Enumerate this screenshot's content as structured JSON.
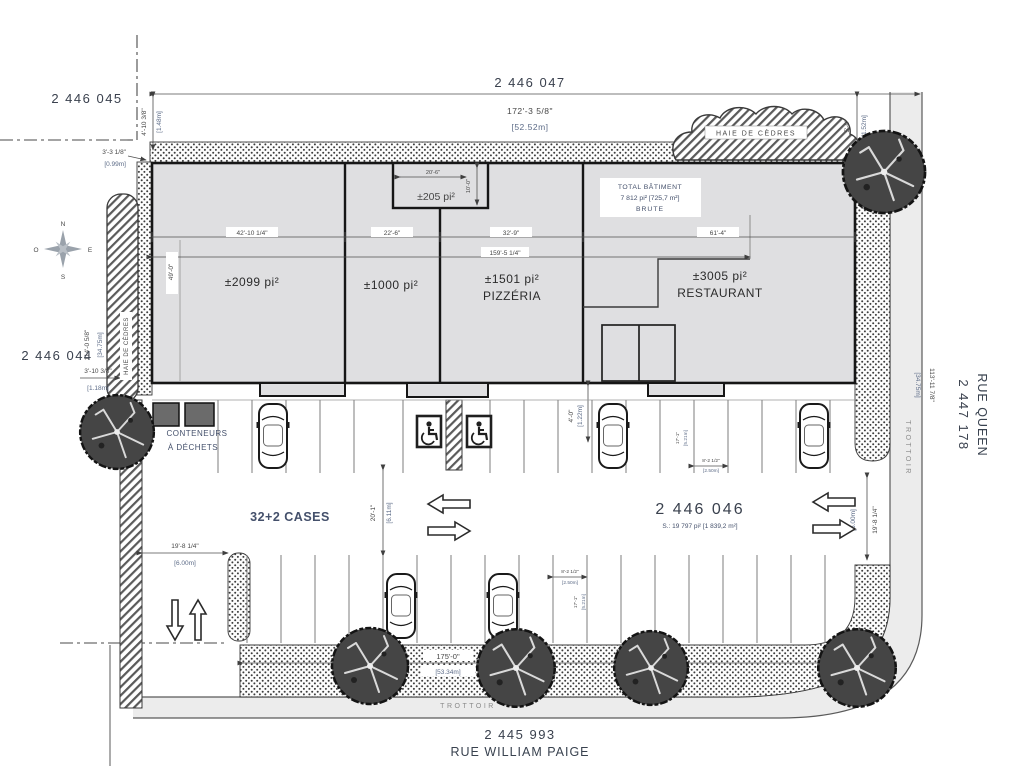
{
  "lots": {
    "l2446045": "2 446 045",
    "l2446047": "2 446 047",
    "l2446044": "2 446 044",
    "l2446046": "2 446 046",
    "l2446046_area": "S.: 19 797 pi² [1 839,2 m²]",
    "l2447178": "2 447 178",
    "l2445993": "2 445 993"
  },
  "streets": {
    "rue_queen": "RUE QUEEN",
    "rue_william_paige": "RUE WILLIAM PAIGE",
    "trottoir_right": "TROTTOIR",
    "trottoir_bottom": "TROTTOIR"
  },
  "building": {
    "total_line1": "TOTAL BÂTIMENT",
    "total_line2": "7 812 pi² [725,7 m²]",
    "total_line3": "BRUTE",
    "unit1_area": "±2099 pi²",
    "unit2_area": "±1000 pi²",
    "unit3_area": "±1501 pi²",
    "unit3_name": "PIZZÉRIA",
    "unit4_area": "±3005 pi²",
    "unit4_name": "RESTAURANT",
    "bump_area": "±205 pi²"
  },
  "site": {
    "cases": "32+2 CASES",
    "conteneurs_line1": "CONTENEURS",
    "conteneurs_line2": "À DÉCHETS",
    "haie_top": "HAIE DE CÈDRES",
    "haie_left": "HAIE DE CÈDRES"
  },
  "compass": {
    "n": "N",
    "e": "E",
    "s": "S",
    "o": "O"
  },
  "dims": {
    "top_w": "172'-3 5/8\"",
    "top_w_m": "[52.52m]",
    "left_offset": "4'-10 3/8\"",
    "left_offset_m": "[1.48m]",
    "corner": "3'-3 1/8\"",
    "corner_m": "[0.99m]",
    "left_len": "114'-0 5/8\"",
    "left_len_m": "[34.75m]",
    "left_gap": "3'-10 3/8\"",
    "left_gap_m": "[1.18m]",
    "seg1": "42'-10 1/4\"",
    "seg2": "22'-6\"",
    "seg3": "32'-9\"",
    "seg4": "61'-4\"",
    "front": "159'-5 1/4\"",
    "depth": "49'-0\"",
    "bump_w": "20'-6\"",
    "bump_h": "10'-0\"",
    "hedge_r": "5'-0\"",
    "hedge_r_m": "[1.52m]",
    "right_len": "113'-11 7/8\"",
    "right_len_m": "[34.75m]",
    "walk": "4'-0\"",
    "walk_m": "[1.22m]",
    "aisle": "20'-1\"",
    "aisle_m": "[6.11m]",
    "drive_w": "19'-8 1/4\"",
    "drive_w_m": "[6.00m]",
    "drive_e": "19'-8 1/4\"",
    "drive_e_m": "[6.00m]",
    "bottom_w": "175'-0\"",
    "bottom_w_m": "[53.34m]",
    "stall_w": "8'-2 1/2\"",
    "stall_w_m": "[2.50m]",
    "stall_d": "17'-1\"",
    "stall_d_m": "[5.21m]"
  }
}
